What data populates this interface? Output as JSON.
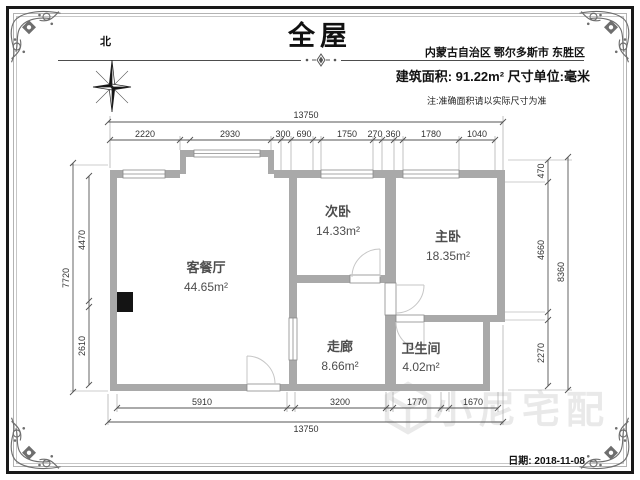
{
  "header": {
    "title": "全屋",
    "north_label": "北",
    "location": "内蒙古自治区 鄂尔多斯市 东胜区",
    "area_info": "建筑面积: 91.22m²  尺寸单位:毫米",
    "note": "注:准确面积请以实际尺寸为准"
  },
  "plan": {
    "rooms": [
      {
        "name": "客餐厅",
        "area": "44.65m²"
      },
      {
        "name": "次卧",
        "area": "14.33m²"
      },
      {
        "name": "主卧",
        "area": "18.35m²"
      },
      {
        "name": "走廊",
        "area": "8.66m²"
      },
      {
        "name": "卫生间",
        "area": "4.02m²"
      }
    ],
    "dims": {
      "top_outer": "13750",
      "top_inner": [
        "2220",
        "2930",
        "300",
        "690",
        "1750",
        "270",
        "360",
        "1780",
        "1040"
      ],
      "left_outer": "7720",
      "left_inner": [
        "4470",
        "2610"
      ],
      "right_outer": "8360",
      "right_inner": [
        "470",
        "4660",
        "2270"
      ],
      "bottom_inner": [
        "5910",
        "3200",
        "1770",
        "1670"
      ],
      "bottom_outer": "13750"
    },
    "colors": {
      "wall": "#a9a9a9",
      "column": "#141414",
      "dim_line": "#555555",
      "watermark": "#e9e9e9"
    }
  },
  "watermark": {
    "text": "小尼宅配"
  },
  "footer": {
    "date": "日期: 2018-11-08"
  }
}
